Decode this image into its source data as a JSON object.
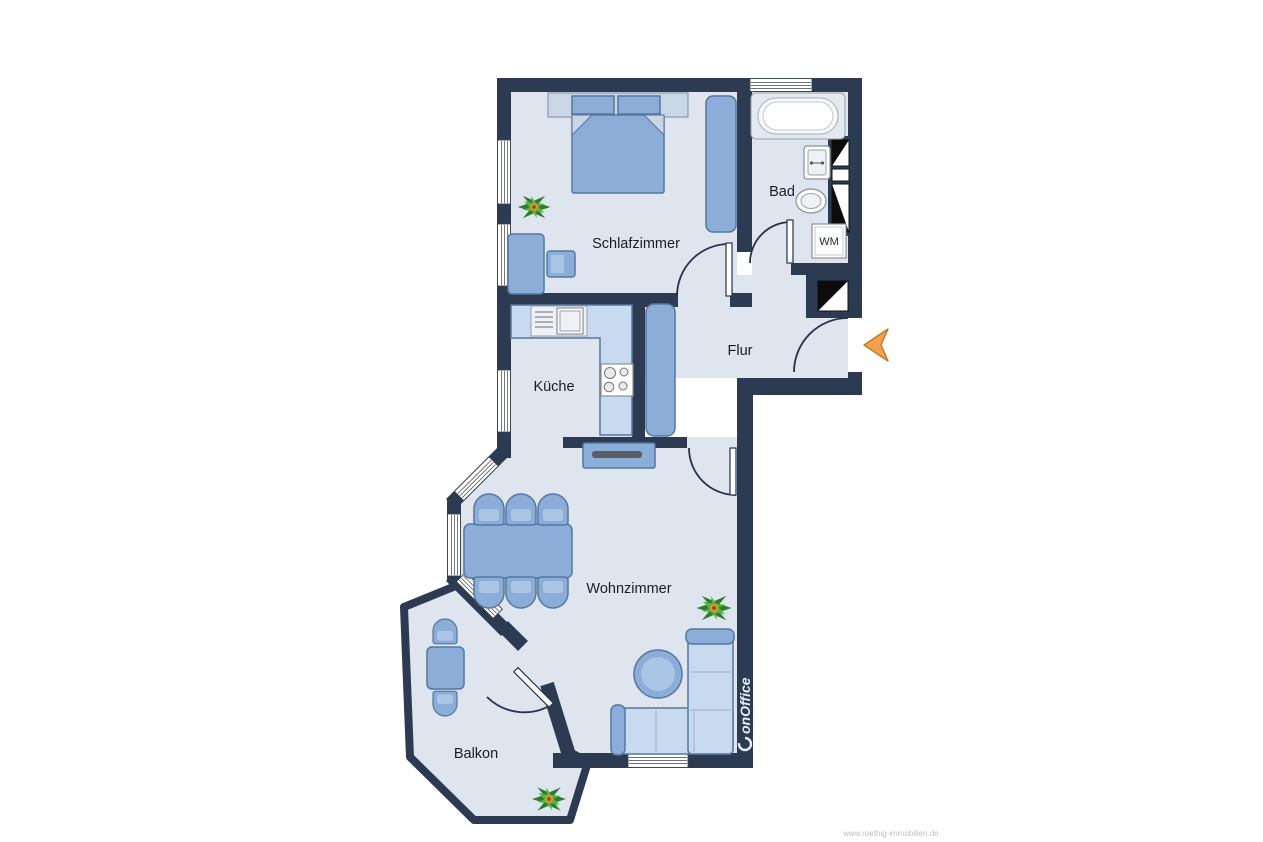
{
  "rooms": {
    "schlafzimmer": "Schlafzimmer",
    "bad": "Bad",
    "flur": "Flur",
    "kueche": "Küche",
    "wohnzimmer": "Wohnzimmer",
    "balkon": "Balkon"
  },
  "appliances": {
    "washing_machine": "WM"
  },
  "watermark": {
    "brand": "onOffice",
    "subtitle": "SOFTWARE"
  },
  "footer": {
    "url": "www.roethig-immobilien.de"
  },
  "colors": {
    "wall": "#2c3a52",
    "floor": "#dfe5ef",
    "furn": "#8badd8",
    "furn-border": "#54779f",
    "furn-light": "#c8daf0",
    "accent": "#f2a24d"
  }
}
